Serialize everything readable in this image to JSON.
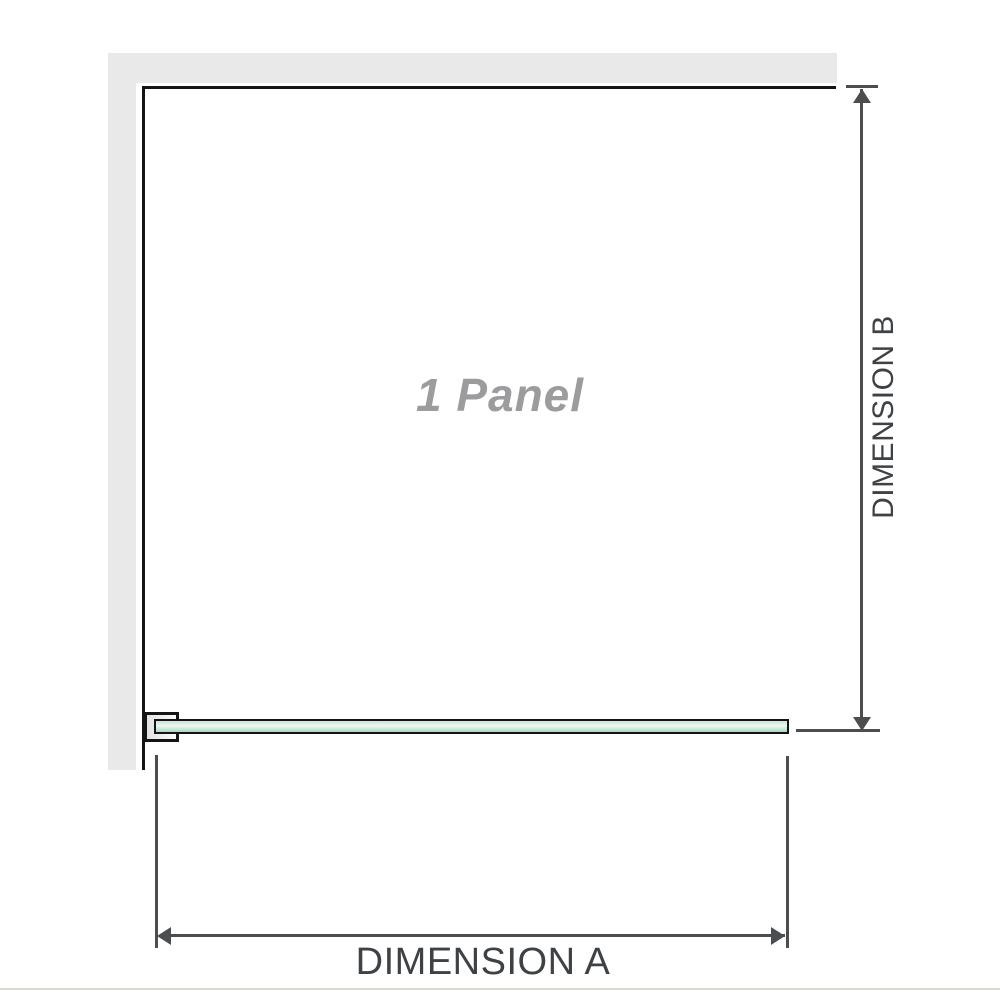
{
  "diagram": {
    "panel_label": "1 Panel",
    "dimension_a": {
      "label": "DIMENSION A"
    },
    "dimension_b": {
      "label": "DIMENSION B"
    },
    "colors": {
      "wall_fill": "#e9e9e9",
      "panel_outline": "#141414",
      "glass_green_top": "#c8e6d6",
      "glass_green_highlight": "#edf7f1",
      "glass_green_bottom": "#a7d7c0",
      "dimension_line": "#4b4d4f",
      "dimension_text": "#3f4245",
      "panel_label_text": "#9c9c9e",
      "baseline_rule": "#dbd7d0"
    },
    "icons": {
      "arrowhead_up": "css-triangle-up",
      "arrowhead_down": "css-triangle-down",
      "arrowhead_left": "css-triangle-left",
      "arrowhead_right": "css-triangle-right"
    }
  }
}
